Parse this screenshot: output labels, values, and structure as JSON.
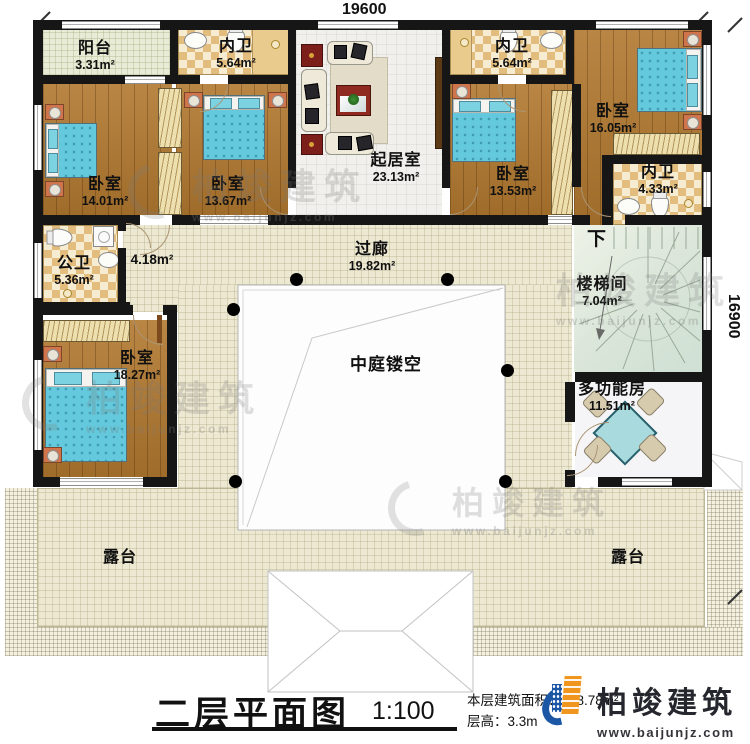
{
  "dimensions": {
    "width_top": "19600",
    "height_right": "16900"
  },
  "rooms": {
    "balcony": {
      "name": "阳台",
      "area": "3.31m²"
    },
    "bath_top_left": {
      "name": "内卫",
      "area": "5.64m²"
    },
    "bath_top_right": {
      "name": "内卫",
      "area": "5.64m²"
    },
    "bedroom_top_right": {
      "name": "卧室",
      "area": "16.05m²"
    },
    "bedroom_left_1": {
      "name": "卧室",
      "area": "14.01m²"
    },
    "bedroom_left_2": {
      "name": "卧室",
      "area": "13.67m²"
    },
    "living_room": {
      "name": "起居室",
      "area": "23.13m²"
    },
    "bedroom_center": {
      "name": "卧室",
      "area": "13.53m²"
    },
    "bath_right": {
      "name": "内卫",
      "area": "4.33m²"
    },
    "public_bath": {
      "name": "公卫",
      "area": "5.36m²"
    },
    "hallway_nook": {
      "area": "4.18m²"
    },
    "corridor": {
      "name": "过廊",
      "area": "19.82m²"
    },
    "stairwell": {
      "name": "楼梯间",
      "area": "7.04m²",
      "direction": "下"
    },
    "atrium": {
      "name": "中庭镂空"
    },
    "bedroom_bottom_left": {
      "name": "卧室",
      "area": "18.27m²"
    },
    "multi_room": {
      "name": "多功能房",
      "area": "11.51m²"
    },
    "terrace_left": {
      "name": "露台"
    },
    "terrace_right": {
      "name": "露台"
    }
  },
  "titleblock": {
    "title": "二层平面图",
    "scale": "1:100",
    "area_label": "本层建筑面积：178.78m²",
    "floor_height_label": "层高：3.3m"
  },
  "brand": {
    "name": "柏竣建筑",
    "url": "www.baijunjz.com"
  },
  "watermark": {
    "name": "柏竣建筑",
    "url": "www.baijunjz.com"
  },
  "colors": {
    "wall": "#161616",
    "wood": "#b1782f",
    "bed": "#64c9dc",
    "tile": "#ece8d1",
    "checker": "#e3bd7e",
    "stair": "#d9e5d8",
    "brand_blue": "#1c57a5",
    "brand_orange": "#f0951e"
  }
}
